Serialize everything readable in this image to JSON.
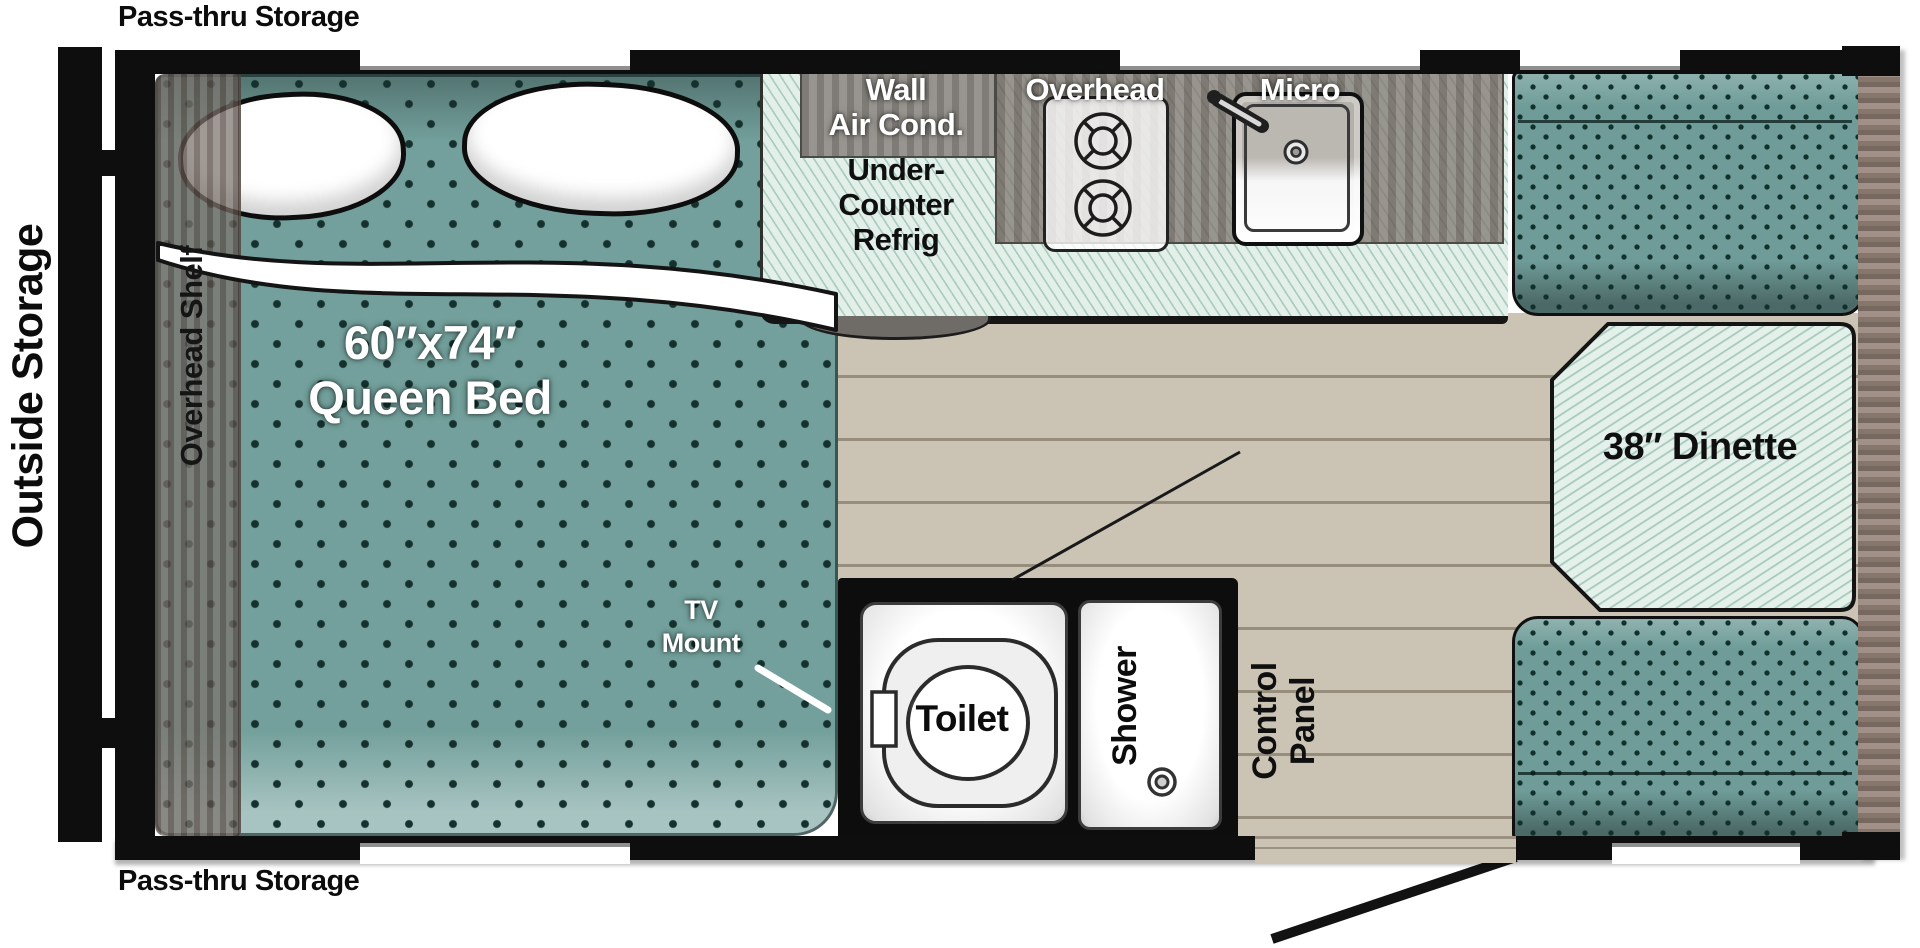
{
  "labels": {
    "pass_thru_top": "Pass-thru Storage",
    "pass_thru_bottom": "Pass-thru Storage",
    "outside_storage": "Outside Storage",
    "overhead_shelf": "Overhead Shelf"
  },
  "bed": {
    "size": "60″x74″",
    "name": "Queen Bed",
    "tv_line1": "TV",
    "tv_line2": "Mount"
  },
  "kitchen": {
    "wall_ac_line1": "Wall",
    "wall_ac_line2": "Air Cond.",
    "fridge_line1": "Under-",
    "fridge_line2": "Counter",
    "fridge_line3": "Refrig",
    "overhead_cabinet": "Overhead",
    "microwave": "Micro"
  },
  "bathroom": {
    "toilet": "Toilet",
    "shower": "Shower"
  },
  "dinette": {
    "label": "38″ Dinette"
  },
  "control_panel": {
    "line1": "Control",
    "line2": "Panel"
  },
  "colors": {
    "wall_black": "#0e0e0e",
    "cushion_teal": "#6f9c98",
    "counter_mint": "#e3f0ea",
    "floor_beige": "#cbc4b5",
    "wood_trim": "#93837a",
    "cabinet_gray": "#8e8b86"
  }
}
